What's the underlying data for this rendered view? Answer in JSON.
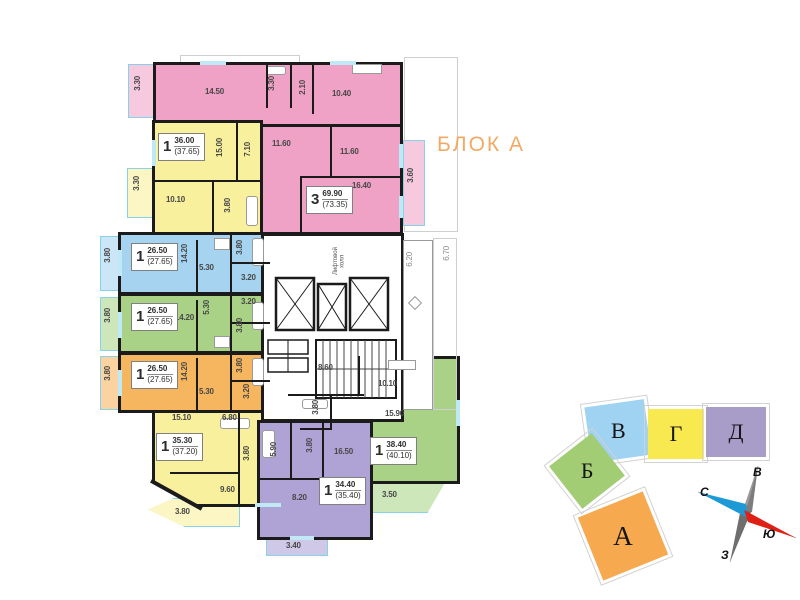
{
  "title": "БЛОК А",
  "plan": {
    "apartments": {
      "pink3": {
        "rooms": "3",
        "area": "69.90",
        "area_total": "(73.35)",
        "living": "14.50",
        "bath": "3.30",
        "wc": "2.10",
        "kitchen": "10.40",
        "hall": "11.60",
        "bedroom": "11.60",
        "bedroom2": "16.40",
        "balcony_left": "3.30",
        "balcony_right": "3.60"
      },
      "yellow_top": {
        "rooms": "1",
        "area": "36.00",
        "area_total": "(37.65)",
        "living": "15.00",
        "hall": "7.10",
        "kitchen": "10.10",
        "bath": "3.80",
        "balcony": "3.30"
      },
      "blue": {
        "rooms": "1",
        "area": "26.50",
        "area_total": "(27.65)",
        "living": "14.20",
        "kitchen": "5.30",
        "bath": "3.80",
        "hall": "3.20",
        "balcony": "3.80"
      },
      "green": {
        "rooms": "1",
        "area": "26.50",
        "area_total": "(27.65)",
        "living": "14.20",
        "kitchen": "5.30",
        "bath": "3.80",
        "hall": "3.20",
        "balcony": "3.80"
      },
      "orange": {
        "rooms": "1",
        "area": "26.50",
        "area_total": "(27.65)",
        "living": "14.20",
        "kitchen": "5.30",
        "bath": "3.80",
        "hall": "3.20",
        "balcony": "3.80"
      },
      "yellow_bottom": {
        "rooms": "1",
        "area": "35.30",
        "area_total": "(37.20)",
        "living": "15.10",
        "hall": "6.80",
        "bath": "3.80",
        "kitchen": "9.60",
        "balcony": "3.80"
      },
      "purple": {
        "rooms": "1",
        "area": "34.40",
        "area_total": "(35.40)",
        "living": "16.50",
        "kitchen": "8.20",
        "hall": "5.90",
        "bath": "3.80",
        "balcony": "3.40"
      },
      "green_right": {
        "rooms": "1",
        "area": "38.40",
        "area_total": "(40.10)",
        "hall": "8.60",
        "kitchen": "10.10",
        "living": "15.90",
        "bath": "3.80",
        "balcony": "3.50"
      }
    },
    "core": {
      "elevator_hall": "Лифтовой холл",
      "dim_inner": "6.20",
      "dim_outer": "6.70"
    }
  },
  "minimap": {
    "blocks": [
      {
        "label": "В",
        "color": "#A0D2F2"
      },
      {
        "label": "Г",
        "color": "#F8E951"
      },
      {
        "label": "Д",
        "color": "#A89DC9"
      },
      {
        "label": "Б",
        "color": "#A2CD74"
      },
      {
        "label": "А",
        "color": "#F7A94F"
      }
    ]
  },
  "compass": {
    "east": "В",
    "north": "С",
    "west": "З",
    "south": "Ю"
  },
  "colors": {
    "pink": "#F0A2C6",
    "yellow": "#F8F09C",
    "blue": "#A6D4F0",
    "green": "#A9D287",
    "orange": "#F6B55F",
    "purple": "#AFA3D6",
    "wall": "#1B1B1B",
    "glazing": "#86D2E8",
    "title": "#F1A964",
    "compass_blue": "#1D9AD6",
    "compass_red": "#E02015",
    "compass_gray": "#7D7D7D"
  }
}
